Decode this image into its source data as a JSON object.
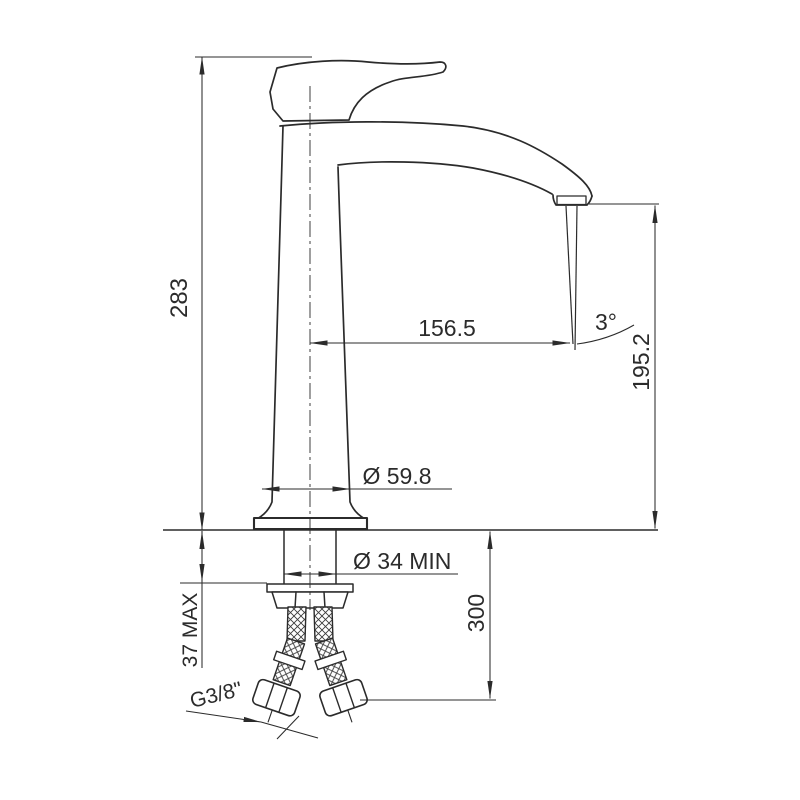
{
  "drawing": {
    "type": "faucet-installation-dimension-drawing",
    "background": "#ffffff",
    "line_color": "#2b2b2b",
    "dimensions": {
      "overall_height": "283",
      "spout_reach": "156.5",
      "stream_angle": "3°",
      "spout_outlet_height": "195.2",
      "base_diameter": "Ø 59.8",
      "min_hole_diameter": "Ø 34 MIN",
      "hose_drop": "300",
      "max_deck_thickness": "37 MAX",
      "thread_size": "G3/8\""
    }
  }
}
